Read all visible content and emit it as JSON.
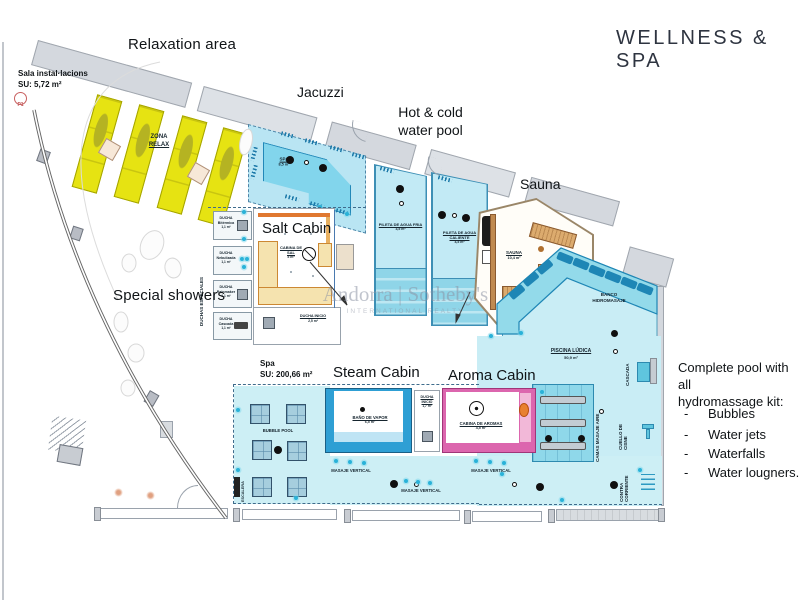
{
  "title": "WELLNESS  &  SPA",
  "watermark": {
    "brand": "Andorra | Sotheby's",
    "sub": "INTERNATIONAL REALTY"
  },
  "labels": {
    "relaxation": "Relaxation area",
    "jacuzzi": "Jacuzzi",
    "hot_cold_line1": "Hot & cold",
    "hot_cold_line2": "water pool",
    "sauna": "Sauna",
    "special_showers": "Special showers",
    "sala_line1": "Sala instal·lacions",
    "sala_line2": "SU: 5,72 m²",
    "spa_su_line1": "Spa",
    "spa_su_line2": "SU: 200,66 m²",
    "p1": "P1"
  },
  "headings": {
    "salt": "Salt Cabin",
    "steam": "Steam Cabin",
    "aroma": "Aroma Cabin"
  },
  "kit": {
    "heading_line1": "Complete pool with all",
    "heading_line2": "hydromassage kit:",
    "dash": "-",
    "items": [
      "Bubbles",
      "Water jets",
      "Waterfalls",
      "Water lougners..."
    ]
  },
  "rooms": {
    "zona_relax_line1": "ZONA",
    "zona_relax_line2": "RELAX",
    "spa_pool": {
      "name": "SPA",
      "area": "8,5 m²"
    },
    "pileta_fria": {
      "name": "PILETA DE AGUA FRIA",
      "area": "3,5 m²"
    },
    "pileta_caliente": {
      "name": "PILETA DE AGUA CALIENTE",
      "area": "4,5 m²"
    },
    "sauna": {
      "name": "SAUNA",
      "area": "10,4 m²"
    },
    "banco": "BANCO HIDROMASAJE",
    "piscina_ludica": {
      "name": "PISCINA LÚDICA",
      "area": "50,9 m²"
    },
    "camas_masaje": "CAMAS MASAJE AIRE",
    "cascada": "CASCADA",
    "cuello_cisne": "CUELLO DE CISNE",
    "contra_corriente": "CONTRA CORRIENTE",
    "cabina_sal": {
      "name": "CABINA DE SAL",
      "area": "5 m²"
    },
    "ducha_inicio_salt": {
      "name": "DUCHA INICIO",
      "area": "2,5 m²"
    },
    "ducha_inicio_steam": {
      "name": "DUCHA INICIO",
      "area": "1,7 m²"
    },
    "bano_vapor": {
      "name": "BAÑO DE VAPOR",
      "area": "6,5 m²"
    },
    "cabina_aromas": {
      "name": "CABINA DE AROMAS",
      "area": "4,5 m²"
    },
    "bubble_pool": "BUBBLE POOL",
    "escalera": "ESCALERA",
    "masaje_vertical": "MASAJE VERTICAL",
    "duchas_especiales": "DUCHAS ESPECIALES",
    "showers": [
      {
        "name": "DUCHA",
        "type": "Bitérmica",
        "area": "1,1 m²"
      },
      {
        "name": "DUCHA",
        "type": "Nebulizada",
        "area": "1,1 m²"
      },
      {
        "name": "DUCHA",
        "type": "Rainmaker",
        "area": "1,1 m²"
      },
      {
        "name": "DUCHA",
        "type": "Cascada",
        "area": "1,1 m²"
      }
    ]
  },
  "colors": {
    "pool_light": "#cdeef5",
    "pool_medium": "#8fd8ea",
    "pool_dark": "#1e86b5",
    "lounger_yellow": "#e6e312",
    "wood": "#dcab6e",
    "steam_blue": "#2e9fd4",
    "aroma_pink": "#dc66ae",
    "salt_orange": "#e07830",
    "wall_gray": "#d4d8de"
  }
}
